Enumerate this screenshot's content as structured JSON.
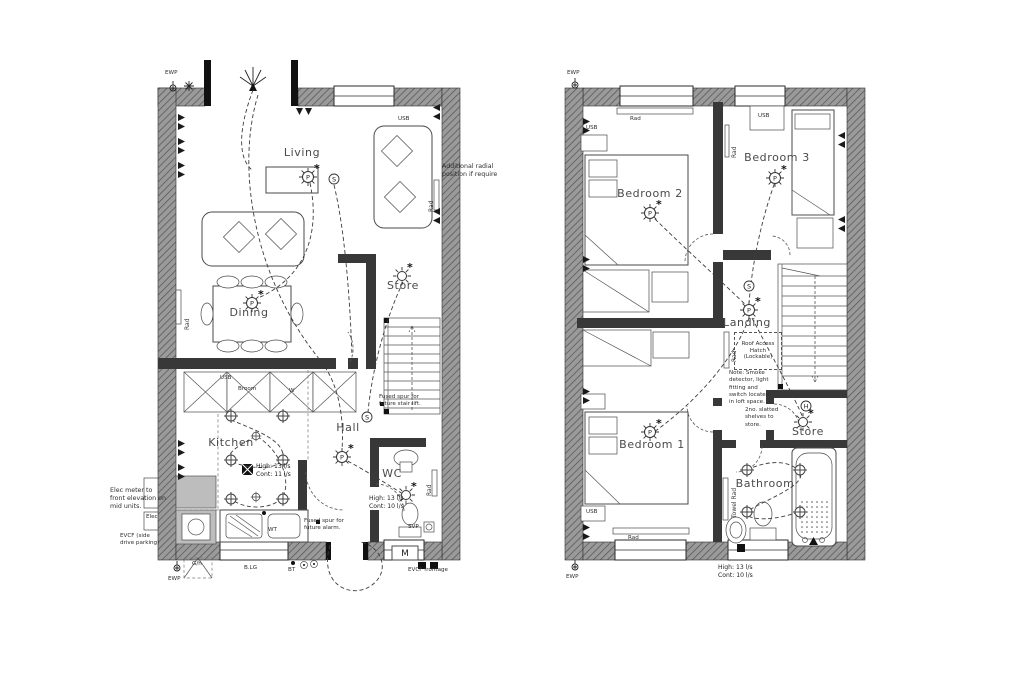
{
  "legend": {
    "pendant": "P",
    "switch": "S",
    "heat": "H",
    "meter": "M",
    "asterisk": "*"
  },
  "shared": {
    "ewp": "EWP",
    "usb": "USB",
    "rad": "Rad",
    "high13": "High: 13 l/s",
    "cont11": "Cont: 11 l/s",
    "cont10": "Cont: 10 l/s"
  },
  "ground": {
    "living": "Living",
    "dining": "Dining",
    "kitchen": "Kitchen",
    "hall": "Hall",
    "store": "Store",
    "wc": "WC",
    "additional_radial": "Additional radial position if require",
    "elec_meter_note": "Elec meter to front elevation on mid units.",
    "elec": "Elec",
    "evcf_side": "EVCF (side drive parking)",
    "evcf_frontage": "EVCF frontage",
    "fused_spur_stair": "Fused spur for future stair lift.",
    "fused_spur_alarm": "Fused spur for future alarm.",
    "gh": "G/h",
    "blg": "B.LG",
    "bt": "BT",
    "svp": "SVP",
    "wt": "WT",
    "broom": "Broom",
    "w_cupboard": "W"
  },
  "first": {
    "bedroom1": "Bedroom 1",
    "bedroom2": "Bedroom 2",
    "bedroom3": "Bedroom 3",
    "landing": "Landing",
    "bathroom": "Bathroom",
    "store": "Store",
    "roof_hatch": "Roof Access Hatch (Lockable)",
    "loft_note": "Note: Smoke detector, light fitting and switch located in loft space.",
    "shelves_note": "2no. slatted shelves to store.",
    "towel_rad": "Towel Rad"
  },
  "colors": {
    "wall_hatch": "#9a9a9a",
    "wall_hatch_line": "#5a5a5a",
    "partition": "#383838",
    "ink": "#3c3c3c"
  }
}
